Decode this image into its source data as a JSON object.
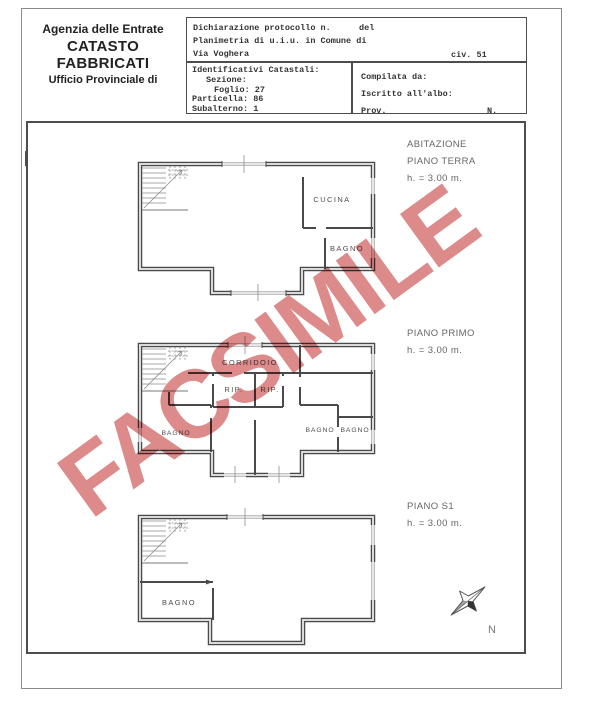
{
  "document": {
    "agency": {
      "line1": "Agenzia delle Entrate",
      "line2": "CATASTO FABBRICATI",
      "line3": "Ufficio Provinciale di"
    },
    "protocol": {
      "declaration_label": "Dichiarazione protocollo n.",
      "del_label": "del",
      "planimetria_line": "Planimetria di u.i.u. in Comune di",
      "street": "Via Voghera",
      "civic": "civ. 51"
    },
    "cadastral_ids": {
      "title": "Identificativi Catastali:",
      "sezione": "Sezione:",
      "foglio": "Foglio: 27",
      "particella": "Particella: 86",
      "subalterno": "Subalterno: 1"
    },
    "compiler": {
      "compilata": "Compilata da:",
      "iscritto": "Iscritto all'albo:",
      "prov": "Prov.",
      "n": "N."
    },
    "scheda": {
      "number": "Scheda n. 1",
      "scale": "Scala 1:200"
    }
  },
  "plans": {
    "terra": {
      "label1": "ABITAZIONE",
      "label2": "PIANO TERRA",
      "height": "h. = 3.00 m.",
      "rooms": {
        "cucina": "CUCINA",
        "bagno": "BAGNO"
      }
    },
    "primo": {
      "label1": "PIANO PRIMO",
      "height": "h. = 3.00 m.",
      "rooms": {
        "corridoio": "CORRIDOIO",
        "rip1": "RIP.",
        "rip2": "RIP.",
        "bagno1": "BAGNO",
        "bagno2": "BAGNO",
        "bagno3": "BAGNO"
      }
    },
    "s1": {
      "label1": "PIANO S1",
      "height": "h. = 3.00 m.",
      "rooms": {
        "bagno": "BAGNO"
      }
    }
  },
  "compass": {
    "north": "N"
  },
  "watermark": {
    "text": "FACSIMILE",
    "color": "#dd8a8a"
  }
}
